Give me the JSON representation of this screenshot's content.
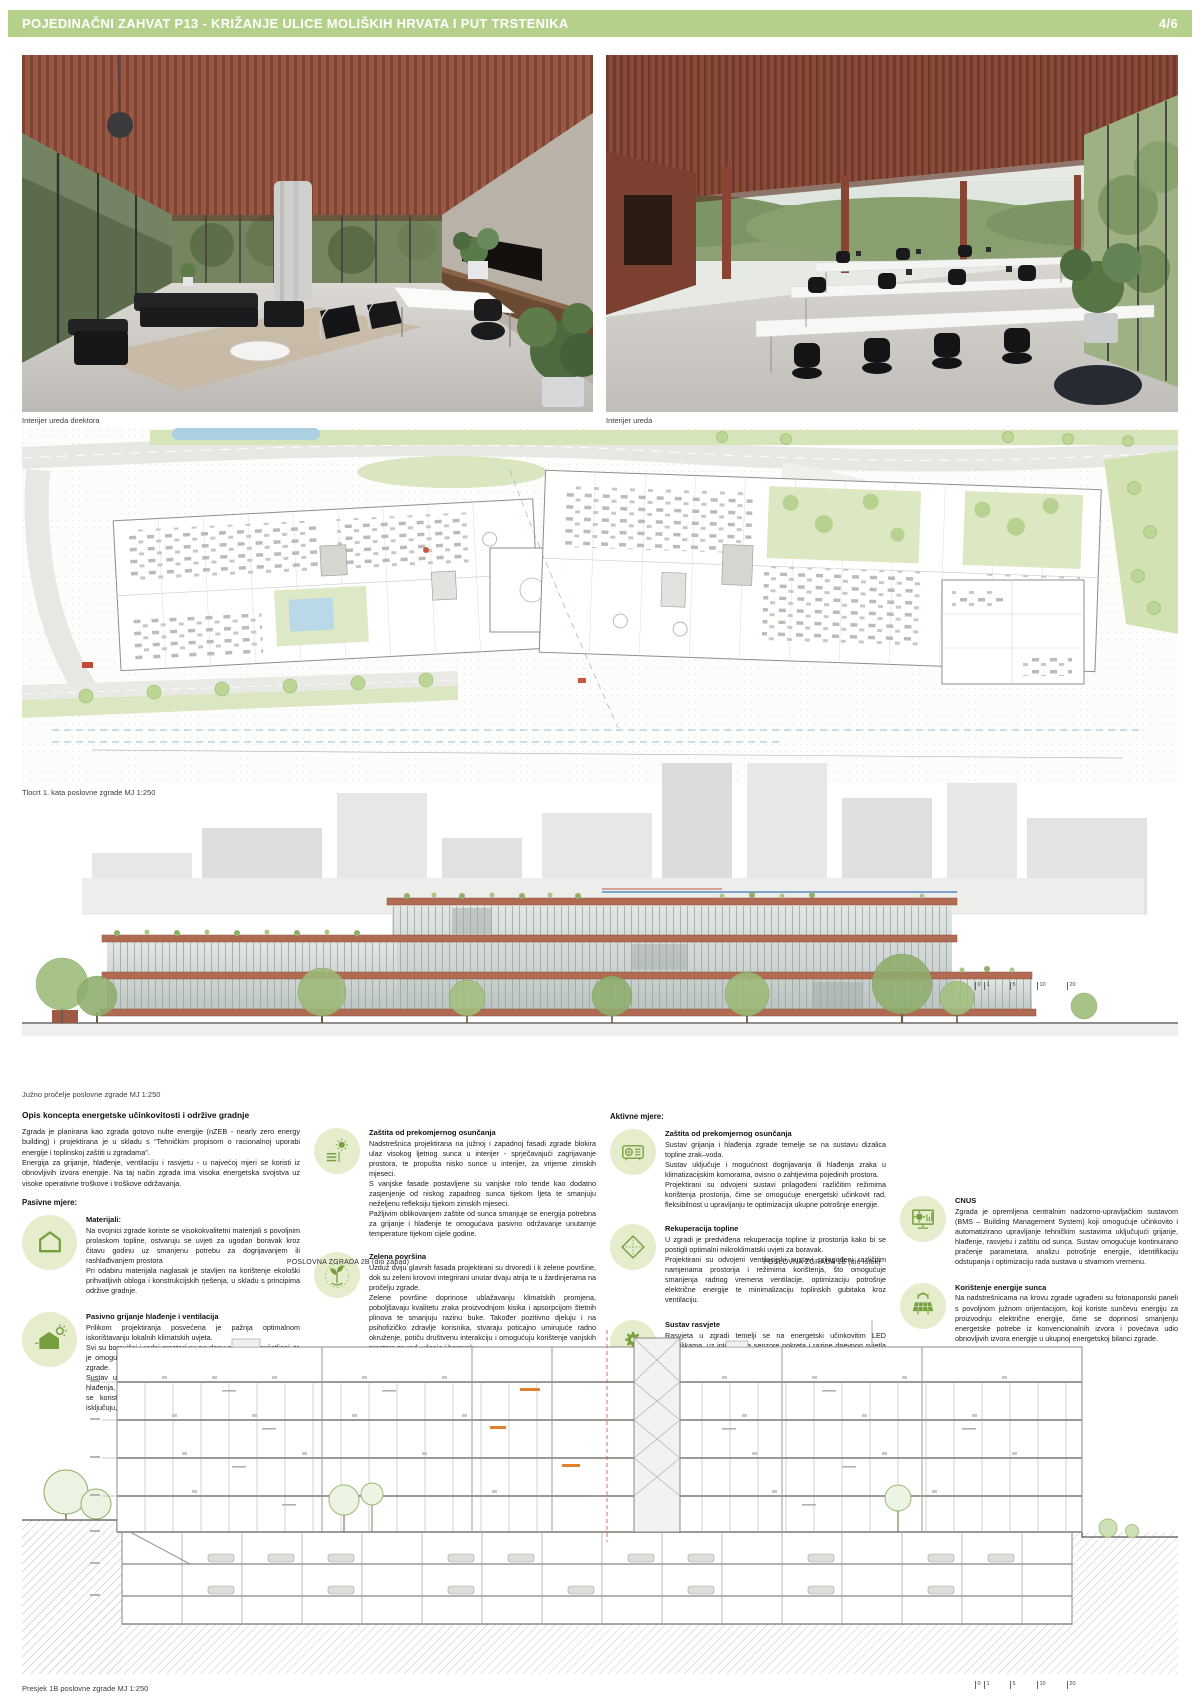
{
  "header": {
    "title": "POJEDINAČNI ZAHVAT P13 - KRIŽANJE ULICE MOLIŠKIH HRVATA I PUT TRSTENIKA",
    "page": "4/6",
    "accent_color": "#b5d08b"
  },
  "renders": {
    "left_caption": "Interijer ureda direktora",
    "right_caption": "Interijer ureda"
  },
  "floor_plan": {
    "caption": "Tlocrt 1. kata poslovne zgrade MJ 1:250"
  },
  "elevation": {
    "caption": "Južno pročelje poslovne zgrade MJ 1:250",
    "scale_ticks": [
      "0",
      "1",
      "5",
      "10",
      "20"
    ]
  },
  "concept": {
    "title": "Opis koncepta energetske učinkovitosti i održive gradnje",
    "intro": "Zgrada je planirana kao zgrada gotovo nulte energije (nZEB - nearly zero energy building) i projektirana je u skladu s “Tehničkim propisom o racionalnoj uporabi energije i toplinskoj zaštiti u zgradama”.\nEnergija za grijanje, hlađenje, ventilaciju i rasvjetu - u najvećoj mjeri se koristi iz obnovljivih izvora energije. Na taj način zgrada ima visoka energetska svojstva uz visoke operativne troškove i troškove održavanja.",
    "passive_heading": "Pasivne mjere:",
    "active_heading": "Aktivne mjere:",
    "passive_items": [
      {
        "icon": "house-outline-icon",
        "title": "Materijali:",
        "body": "Na ovojnici zgrade koriste se visokokvalitetni materijali s povoljnim prolaskom topline, ostvaruju se uvjeti za ugodan boravak kroz čitavu godinu uz smanjenu potrebu za dogrijavanjem ili rashlađivanjem prostora\nPri odabiru materijala naglasak je stavljen na korištenje ekološki prihvatljivih obloga i konstrukcijskih rješenja, u skladu s principima održive gradnje."
      },
      {
        "icon": "passive-house-sun-icon",
        "title": "Pasivno grijanje hlađenje i ventilacija",
        "body": "Prilikom projektiranja posvećena je pažnja optimalnom iskorištavanju lokalnih klimatskih uvjeta.\nSvi su boravišni i radni prostori su po danu prirodno osvijetljeni, te je omogućena i prirodna ventilacija kao najjeftiniji oblik hlađenja zgrade.\nSustav upravljanja omogućuje automatsku regulaciju grijanja i hlađenja, tako da se prilikom otvaranja prozora u prostorijama gdje se koristi prirodna ventilacija, mehanički sustavi automatski isključuju, čime se manjuje nepotrebna potrošnja energije."
      }
    ],
    "shading_items": [
      {
        "icon": "sun-shading-icon",
        "title": "Zaštita od prekomjernog osunčanja",
        "body": "Nadstrešnica projektirana na južnoj i zapadnoj fasadi zgrade blokira ulaz visokog ljetnog sunca u interijer - sprječavajući zagrijavanje prostora, te propušta nisko sunce u interijer, za vrijeme zimskih mjeseci.\nS vanjske fasade postavljene su vanjske rolo tende kao dodatno zasjenjenje od niskog zapadnog sunca tijekom ljeta te smanjuju neželjenu refleksiju tijekom zimskih mjeseci.\nPažljivim oblikovanjem zaštite od sunca smanjuje se energija potrebna za grijanje i hlađenje te omogućava pasivno održavanje unutarnje temperature tijekom cijele godine."
      },
      {
        "icon": "green-plant-icon",
        "title": "Zelena površina",
        "body": "Uzduž dviju glavnih fasada projektirani su drvoredi i k zelene površine, dok su zeleni krovovi integrirani unutar dvaju atrija te u žardinjerama na pročelju zgrade.\nZelene površine doprinose ublažavanju klimatskih promjena, poboljšavaju kvalitetu zraka proizvodnjom kisika i apsorpcijom štetnih plinova te smanjuju razinu buke. Također pozitivno djeluju i na psihofizičko zdravlje korisnika, stvaraju poticajno umirujuće radno okruženje, potiču društvenu interakciju i omogućuju korištenje vanjskih prostora za rad, učenje i boravak."
      },
      {
        "icon": "rainwater-droplet-icon",
        "title": "Korištenje kišnice",
        "body": "Skuplja se kišnice s krovnih površina zgrade. Prikupljena voda se vodi u podzemne spremnike smještene ispod prilaznih trgova zgrade, gdje se skladišti za kasniju upotrebu.\nSakupljena kišnica koristi se za navodnjavanje zelenih površina, čime se dugoročno smanjuju troškovi održavanja i rasterećuje potrošnja pitke vode. Budući da ne sadrži klor ni druga kemijske dodatke, kišnica je ekološki prihvatljiv izbor za navodnjavanje."
      }
    ],
    "active_items": [
      {
        "icon": "heat-pump-icon",
        "title": "Zaštita od prekomjernog osunčanja",
        "body": "Sustav grijanja i hlađenja zgrade temelje se na sustavu dizalica topline zrak–voda.\nSustav uključuje i mogućnost dogrijavanja ili hlađenja zraka u klimatizacijskim komorama, ovisno o zahtjevima pojedinih prostora.\nProjektirani su odvojeni sustavi prilagođeni različitim režimima korištenja prostorija, čime se omogućuje energetski učinkovit rad, fleksibilnost u upravljanju te optimizacija ukupne potrošnje energije."
      },
      {
        "icon": "heat-recovery-icon",
        "title": "Rekuperacija topline",
        "body": "U zgradi je predviđena rekuperacija topline iz prostorija kako bi se postigli optimalni mikroklimatski uvjeti za boravak.\nProjektirani su odvojeni ventilacijski sustavi prilagođeni različitim namjenama prostorija i režimima korištenja, što omogućuje smanjenja radnog vremena ventilacije, optimizaciju potrošnje električne energije te minimalizaciju toplinskih gubitaka kroz ventilaciju."
      },
      {
        "icon": "led-lighting-icon",
        "title": "Sustav rasvjete",
        "body": "Rasvjeta u zgradi temelji se na energetski učinkovitim LED svjetiljkama, uz integrirane senzore pokreta i razine dnevnog svjetla koji omogućuju automatsku regulaciju intenziteta osvjetljenja prema stvarnim potrebama korištenja prostora.\nPrimjenom ovakvog sustava značajno se smanjuje potrošnja električne energije, čime se doprinosi ukupnoj energetskoj učinkovitosti zgrade i rasterećuje elektroenergetska mreža"
      }
    ],
    "systems_items": [
      {
        "icon": "bms-monitor-icon",
        "title": "CNUS",
        "body": "Zgrada je opremljena centralnim nadzorno-upravljačkim sustavom (BMS – Building Management System) koji omogućuje učinkovito i automatizirano upravljanje tehničkim sustavima uključujući grijanje, hlađenje, rasvjetu i zaštitu od sunca. Sustav omogućuje kontinuirano praćenje parametara, analizu potrošnje energije, identifikaciju odstupanja i optimizaciju rada sustava u stvarnom vremenu."
      },
      {
        "icon": "solar-panel-icon",
        "title": "Korištenje energije sunca",
        "body": "Na nadstrešnicama na krovu zgrade ugrađeni su fotonaponski paneli s povoljnom južnom orijentacijom, koji koriste sunčevu energiju za proizvodnju električne energije, čime se doprinosi smanjenju energetske potrebe iz konvencionalnih izvora i povećava udio obnovljivih izvora energije u ukupnoj energetskoj bilanci zgrade."
      }
    ]
  },
  "section": {
    "label_left": "POSLOVNA ZGRADA 2B (dio zapad)",
    "label_right": "POSLOVNA ZGRADA 1B (dio istok)",
    "caption": "Presjek 1B poslovne zgrade MJ 1:250",
    "scale_ticks": [
      "0",
      "1",
      "5",
      "10",
      "20"
    ]
  },
  "colors": {
    "header_green": "#b5d08b",
    "icon_green": "#76a03f",
    "icon_circle_bg": "#e5edcd",
    "slab_red": "#b16b53",
    "plan_green": "#d6e4ba"
  }
}
